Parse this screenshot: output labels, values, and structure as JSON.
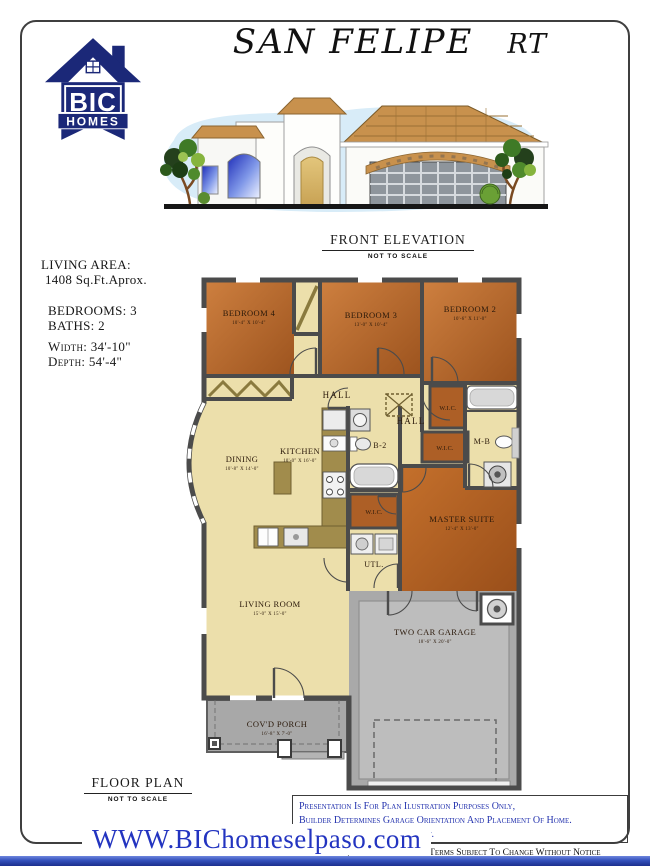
{
  "page": {
    "title": "SAN FELIPE",
    "title_suffix": "RT",
    "website": "WWW.BIChomeselpaso.com",
    "footer_notice": "Plans, Specifications And Terms Subject To Change Without Notice"
  },
  "logo": {
    "line1": "BIC",
    "line2": "HOMES"
  },
  "elevation": {
    "label": "FRONT ELEVATION",
    "sublabel": "NOT TO SCALE"
  },
  "info": {
    "living_area_label": "LIVING AREA:",
    "living_area_value": "1408 Sq.Ft.Aprox.",
    "bedrooms": "BEDROOMS: 3",
    "baths": "BATHS: 2",
    "width": "Width: 34'-10\"",
    "depth": "Depth: 54'-4\""
  },
  "floor_plan": {
    "label": "FLOOR PLAN",
    "sublabel": "NOT TO SCALE",
    "rooms": {
      "bedroom4": {
        "name": "BEDROOM 4",
        "dims": "10'-4\" X 10'-4\""
      },
      "bedroom3": {
        "name": "BEDROOM 3",
        "dims": "13'-0\" X 10'-4\""
      },
      "bedroom2": {
        "name": "BEDROOM 2",
        "dims": "10'-6\" X 11'-0\""
      },
      "hall1": {
        "name": "HALL"
      },
      "hall2": {
        "name": "HALL"
      },
      "wic1": {
        "name": "W.I.C."
      },
      "wic2": {
        "name": "W.I.C."
      },
      "wic3": {
        "name": "W.I.C."
      },
      "master_bath": {
        "name": "M-B"
      },
      "bath2": {
        "name": "B-2"
      },
      "dining": {
        "name": "DINING",
        "dims": "10'-8\" X 14'-0\""
      },
      "kitchen": {
        "name": "KITCHEN",
        "dims": "10'-0\" X 16'-0\""
      },
      "master": {
        "name": "MASTER SUITE",
        "dims": "12'-4\" X 13'-0\""
      },
      "utility": {
        "name": "UTL."
      },
      "living": {
        "name": "LIVING ROOM",
        "dims": "15'-0\" X 15'-0\""
      },
      "garage": {
        "name": "TWO CAR GARAGE",
        "dims": "18'-6\" X 20'-0\""
      },
      "porch": {
        "name": "COV'D PORCH",
        "dims": "16'-8\" X 7'-0\""
      }
    }
  },
  "disclaimer": {
    "line1": "Presentation Is For Plan Ilustration Purposes Only,",
    "line2": "Builder Determines Garage Orientation And Placement Of Home.",
    "line3": "Site Plan Will Show Placement."
  },
  "colors": {
    "accent_blue": "#2433ae",
    "bar_blue": "#3350bb",
    "logo_navy": "#1b2878",
    "room_orange": "#b9702f",
    "room_pale": "#ecdfab"
  }
}
